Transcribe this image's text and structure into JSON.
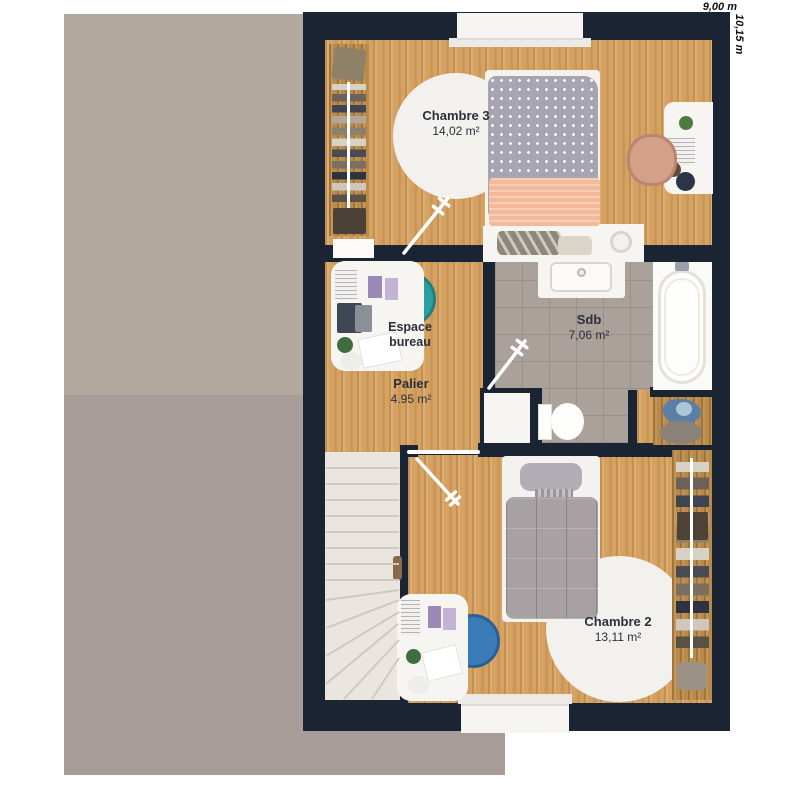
{
  "plan": {
    "floor_label": "étage",
    "dimensions": {
      "width": "9,00 m",
      "height": "10,15 m"
    },
    "rooms": {
      "chambre3": {
        "name": "Chambre 3",
        "area": "14,02 m²"
      },
      "espace_bureau": {
        "name": "Espace bureau"
      },
      "palier": {
        "name": "Palier",
        "area": "4.95 m²"
      },
      "sdb": {
        "name": "Sdb",
        "area": "7,06 m²"
      },
      "chambre2": {
        "name": "Chambre 2",
        "area": "13,11 m²"
      }
    }
  },
  "colors": {
    "wall": "#1b2433",
    "wood": "#d5a262",
    "wood_dark": "#b98a4a",
    "tile": "#a9a19a",
    "tile_line": "#99918a",
    "roof_light": "#b3a89d",
    "roof_dark": "#a79c98",
    "rug": "#f3f1ed",
    "stairs": "#eae6df",
    "stair_line": "#cfc8bd",
    "chair_teal": "#2ba0a1",
    "chair_blue": "#3b7ab8",
    "chair_peach": "#d5a089",
    "duvet_gray": "#a8a5b2",
    "duvet_taupe": "#a7a1a3",
    "blanket_peach": "#f4b998",
    "towel_blue": "#5b7fa6",
    "white_furniture": "#f6f5f2"
  }
}
